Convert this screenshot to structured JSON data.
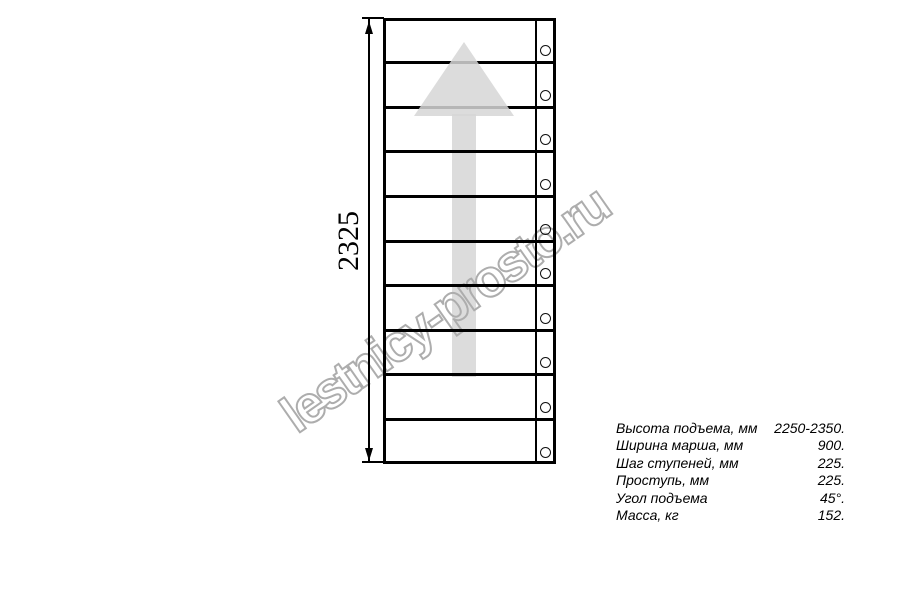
{
  "drawing": {
    "dimension_label": "2325",
    "step_count": 10,
    "colors": {
      "line": "#000000",
      "arrow_fill": "#dcdcdc",
      "watermark_stroke": "#adadad"
    }
  },
  "watermark": {
    "text": "lestnicy-prosto.ru"
  },
  "specs": {
    "rows": [
      {
        "label": "Высота подъема, мм",
        "value": "2250-2350."
      },
      {
        "label": "Ширина марша, мм",
        "value": "900."
      },
      {
        "label": "Шаг ступеней, мм",
        "value": "225."
      },
      {
        "label": "Проступь, мм",
        "value": "225."
      },
      {
        "label": "Угол подъема",
        "value": "45°."
      },
      {
        "label": "Масса, кг",
        "value": "152."
      }
    ]
  }
}
